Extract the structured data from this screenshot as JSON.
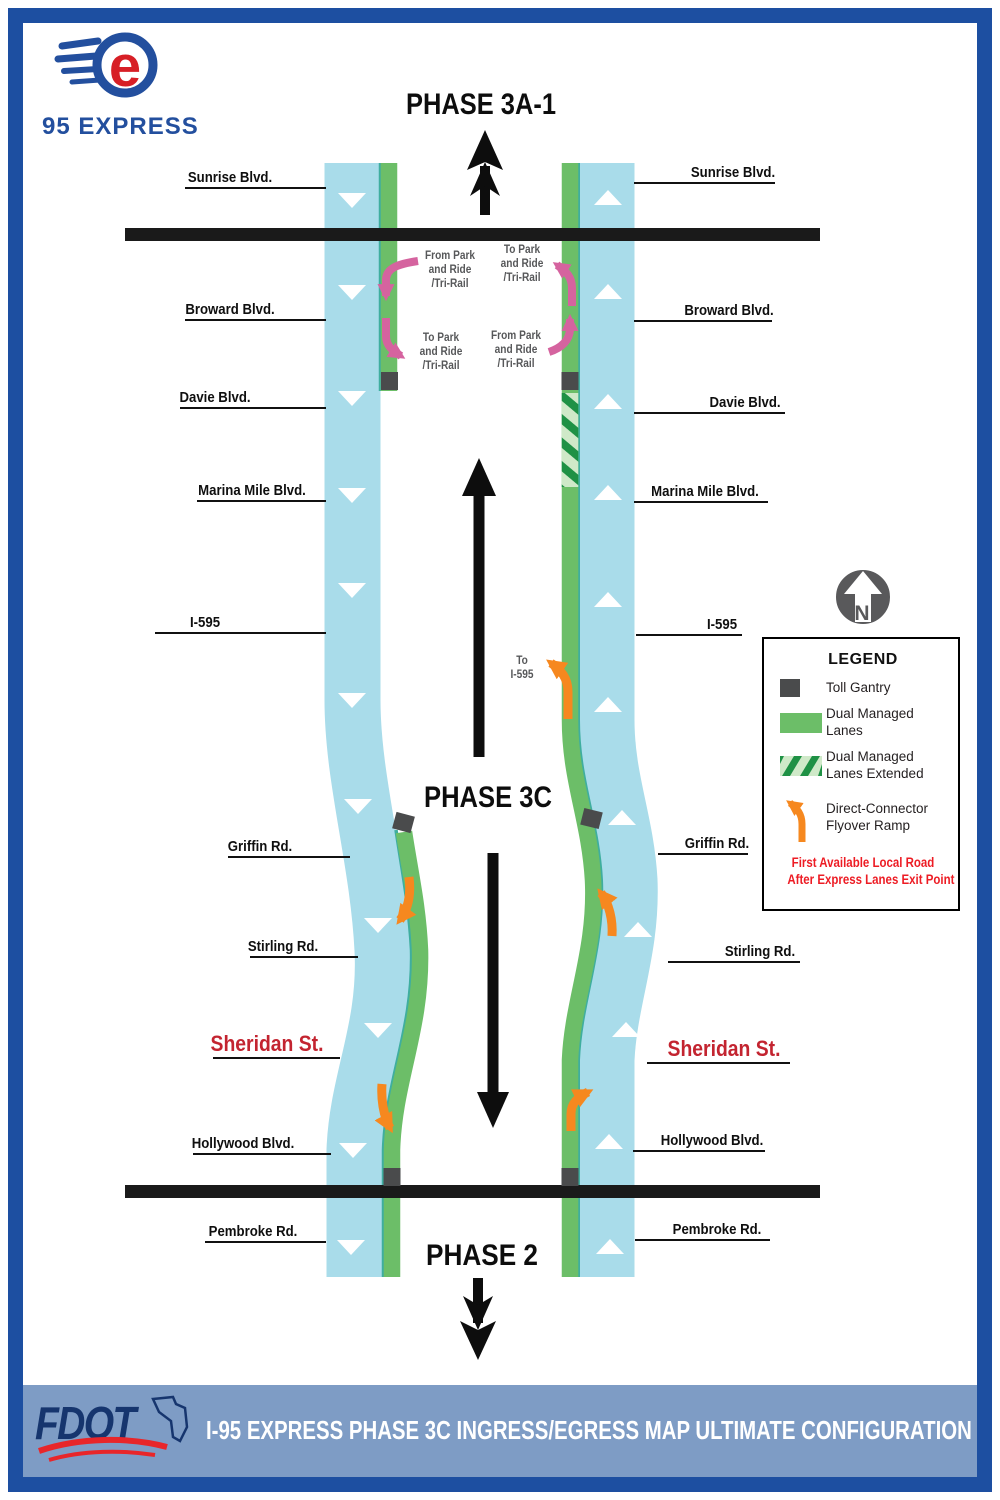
{
  "brand": {
    "letter": "e",
    "name": "95 EXPRESS"
  },
  "phase_labels": {
    "top": "PHASE 3A-1",
    "middle": "PHASE 3C",
    "bottom": "PHASE 2"
  },
  "left_streets": [
    {
      "label": "Sunrise Blvd."
    },
    {
      "label": "Broward Blvd."
    },
    {
      "label": "Davie Blvd."
    },
    {
      "label": "Marina Mile Blvd."
    },
    {
      "label": "I-595"
    },
    {
      "label": "Griffin Rd."
    },
    {
      "label": "Stirling Rd."
    },
    {
      "label": "Sheridan St."
    },
    {
      "label": "Hollywood Blvd."
    },
    {
      "label": "Pembroke Rd."
    }
  ],
  "right_streets": [
    {
      "label": "Sunrise Blvd."
    },
    {
      "label": "Broward Blvd."
    },
    {
      "label": "Davie Blvd."
    },
    {
      "label": "Marina Mile Blvd."
    },
    {
      "label": "I-595"
    },
    {
      "label": "Griffin Rd."
    },
    {
      "label": "Stirling Rd."
    },
    {
      "label": "Sheridan St."
    },
    {
      "label": "Hollywood Blvd."
    },
    {
      "label": "Pembroke Rd."
    }
  ],
  "ramps": {
    "sb_ingress": [
      "From Park",
      "and Ride",
      "/Tri-Rail"
    ],
    "sb_egress": [
      "To Park",
      "and Ride",
      "/Tri-Rail"
    ],
    "nb_egress": [
      "To Park",
      "and Ride",
      "/Tri-Rail"
    ],
    "nb_ingress": [
      "From Park",
      "and Ride",
      "/Tri-Rail"
    ],
    "to_i595": [
      "To",
      "I-595"
    ]
  },
  "north": {
    "letter": "N"
  },
  "legend": {
    "title": "LEGEND",
    "items": [
      {
        "label": "Toll Gantry"
      },
      {
        "label": "Dual Managed Lanes"
      },
      {
        "label": "Dual Managed Lanes Extended"
      },
      {
        "label": "Direct-Connector Flyover Ramp"
      }
    ],
    "note": [
      "First Available Local Road",
      "After Express Lanes Exit Point"
    ]
  },
  "footer": {
    "agency": "FDOT",
    "title": "I-95 EXPRESS PHASE 3C INGRESS/EGRESS MAP ULTIMATE CONFIGURATION"
  },
  "colors": {
    "roadway_blue": "#a9dcea",
    "managed_lane_green": "#6cbe68",
    "lane_edge_teal": "#3fae9f",
    "extended_stripe_green": "#1f9145",
    "flyover_orange": "#f6881f",
    "park_ride_pink": "#d5639f",
    "toll_gantry_gray": "#4a4b4c",
    "phase_divider_black": "#1a1a1a",
    "note_red": "#ed1c24",
    "street_red": "#c32430",
    "border_blue": "#1d4fa1",
    "footer_band_blue": "#7e9cc5"
  }
}
